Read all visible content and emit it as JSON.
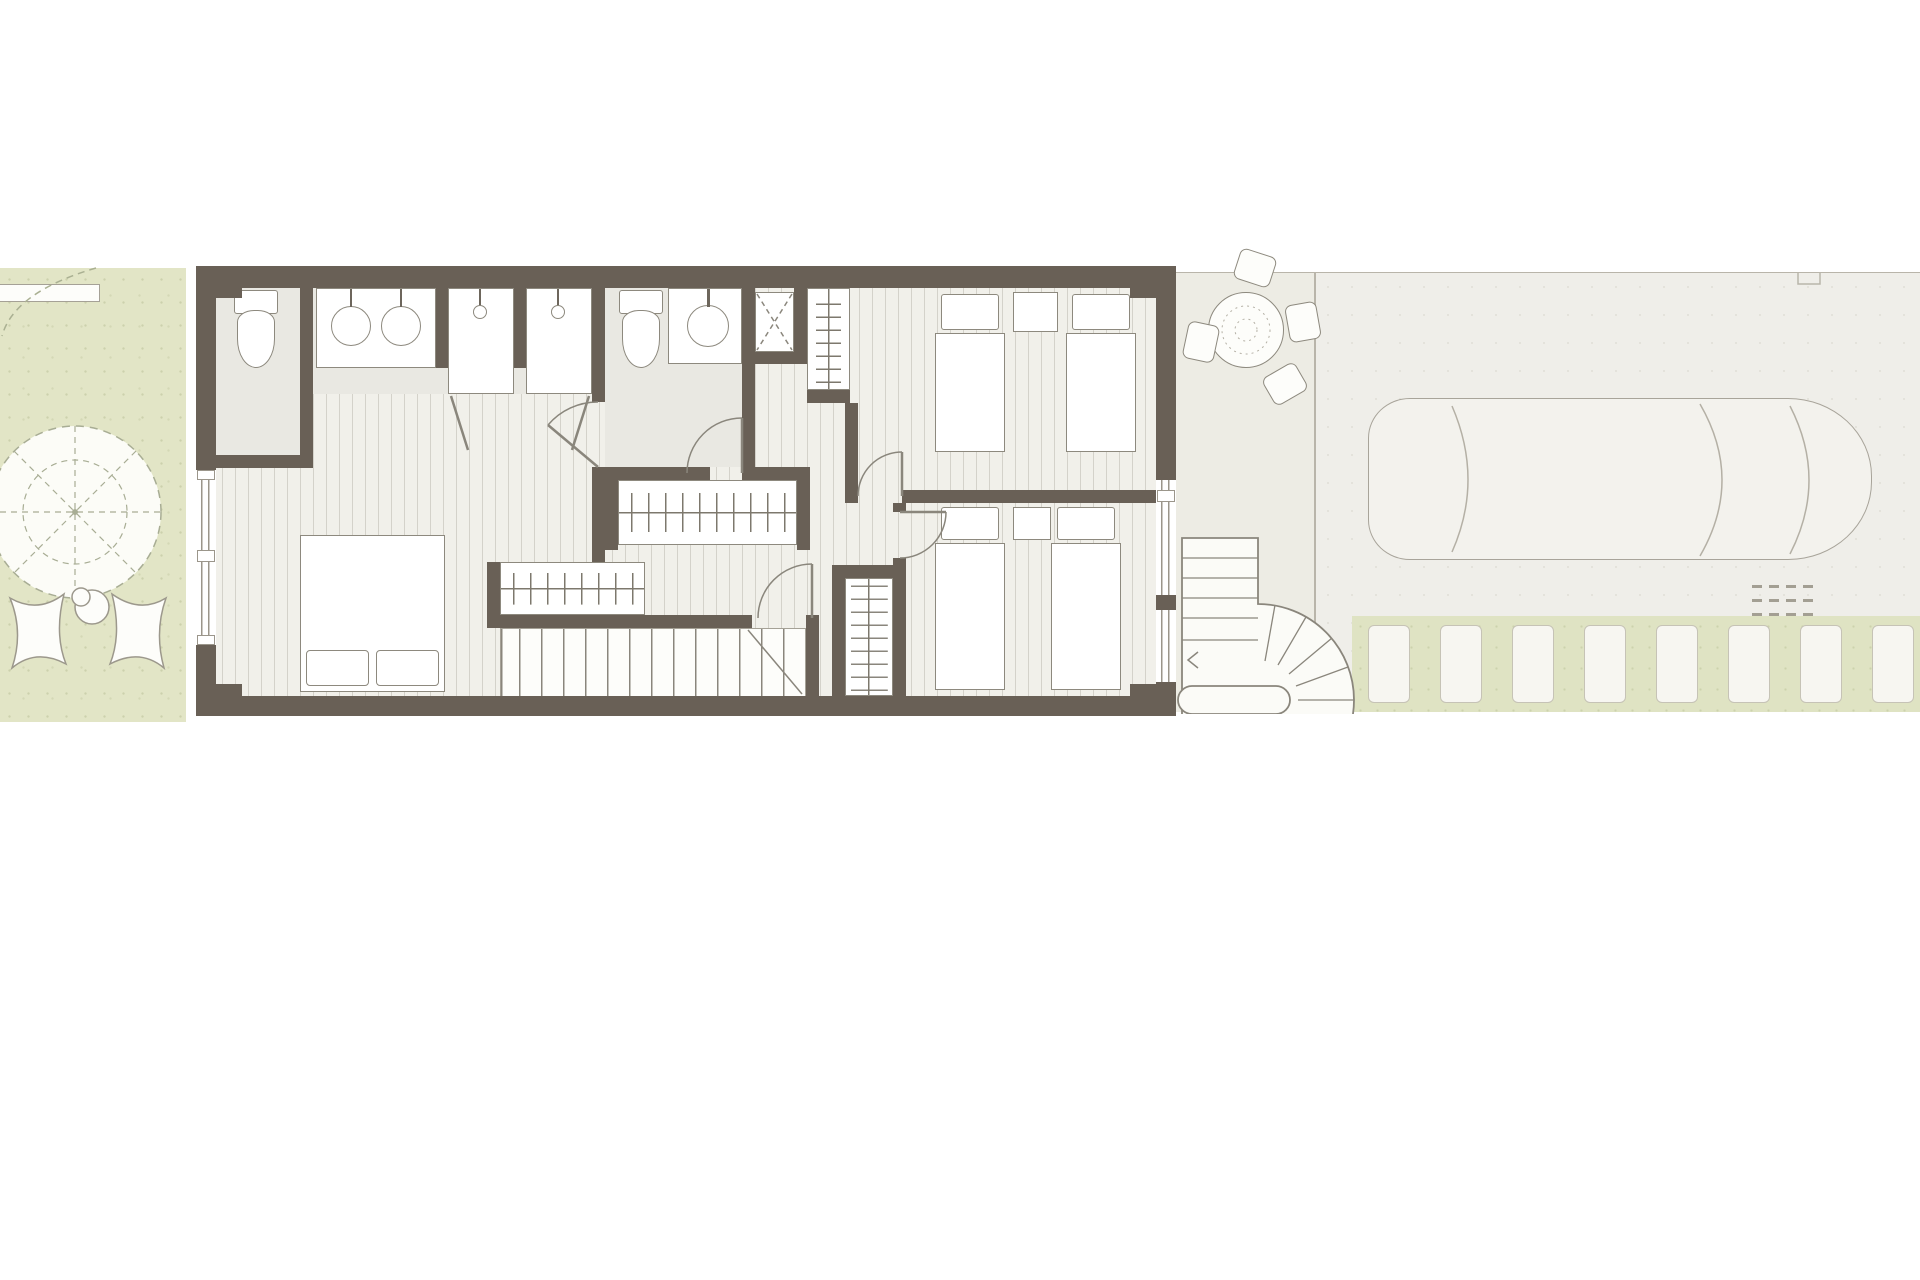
{
  "meta": {
    "title": "Townhouse upper floor plan",
    "drawing_type": "architectural floor plan, top view, no text labels"
  },
  "palette": {
    "wall": "#696056",
    "wood_floor": "#f1f0ea",
    "bath_floor": "#e9e8e2",
    "garden_green": "#e2e5c6",
    "lawn_strip_green": "#dfe3c3",
    "terrace_beige": "#edece4",
    "driveway_beige": "#efeee9",
    "fixture_outline": "#8d897e",
    "fixture_fill": "#ffffff"
  },
  "areas": {
    "garden": {
      "name": "Garden strip with parasol and lounge chairs"
    },
    "building": {
      "name": "Upper floor of townhouse"
    },
    "terrace": {
      "name": "Side terrace with dining set and spiral stair"
    },
    "driveway": {
      "name": "Driveway with parked car"
    }
  },
  "rooms": {
    "master_bedroom": {
      "name": "Master bedroom with open en-suite"
    },
    "wc_niche": {
      "name": "WC niche"
    },
    "vanity_1": {
      "name": "Double washbasin vanity"
    },
    "shower_1": {
      "name": "Shower cabin"
    },
    "shower_2": {
      "name": "Shower cabin"
    },
    "bathroom_2": {
      "name": "Second bathroom"
    },
    "shaft": {
      "name": "Installation shaft"
    },
    "linen_closet": {
      "name": "Built-in closet with rail"
    },
    "hallway": {
      "name": "Landing / hallway"
    },
    "bedroom_2": {
      "name": "Bedroom with two single beds (top right)"
    },
    "bedroom_3": {
      "name": "Bedroom with two single beds (bottom right)"
    },
    "stairs": {
      "name": "Main staircase to lower floor"
    },
    "ladder_stair": {
      "name": "Secondary narrow stair"
    },
    "wardrobe_1": {
      "name": "Wardrobe with hanging rail"
    },
    "wardrobe_2": {
      "name": "Wardrobe with hanging rail"
    }
  },
  "exterior_items": {
    "bench": {
      "name": "Garden bench"
    },
    "parasol": {
      "name": "Parasol (top view, dashed ribs)"
    },
    "lounge_chairs": {
      "name": "Two butterfly lounge chairs",
      "count": 2
    },
    "side_table": {
      "name": "Round side table with cup"
    },
    "dining_table": {
      "name": "Round terrace table",
      "chair_count": 4
    },
    "spiral_stair": {
      "name": "External spiral staircase"
    },
    "car": {
      "name": "Parked car (top view)"
    },
    "stepping_planks": {
      "name": "White stepping planks in lawn",
      "count": 8
    },
    "grate": {
      "name": "Small drainage grate dashes"
    }
  }
}
